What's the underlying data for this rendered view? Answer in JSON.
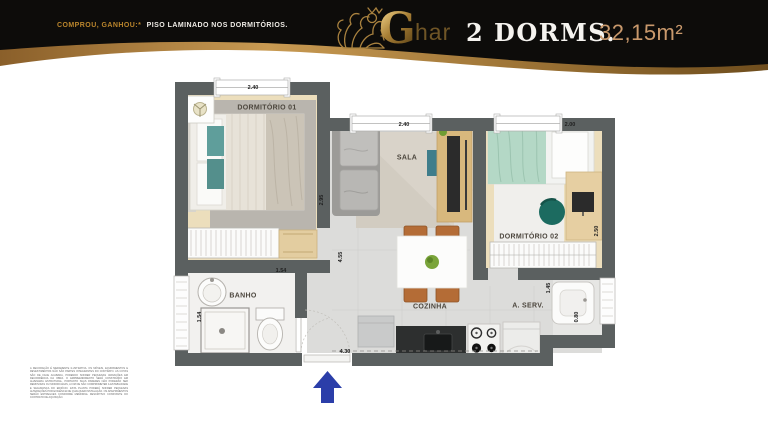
{
  "header": {
    "promo": {
      "highlight": "COMPROU, GANHOU:*",
      "rest": "PISO LAMINADO NOS DORMITÓRIOS."
    },
    "brand": {
      "g": "G",
      "har": "har",
      "lion_icon": "lion-logo-icon"
    },
    "dorms_label": "2 DORMS.",
    "area_label": "32,15m²",
    "colors": {
      "banner_black": "#0d0c0a",
      "gold": "#b9852c",
      "tan": "#c9996c"
    }
  },
  "floorplan": {
    "labels": {
      "dorm01": "DORMITÓRIO 01",
      "sala": "SALA",
      "dorm02": "DORMITÓRIO 02",
      "banho": "BANHO",
      "cozinha": "COZINHA",
      "aserv": "A. SERV."
    },
    "dims": {
      "dorm01_width": "2.40",
      "sala_width": "2.40",
      "dorm02_width": "2.00",
      "dorm01_depth": "2.95",
      "dorm02_depth": "2.50",
      "banho_width": "1.54",
      "banho_depth": "1.54",
      "living_depth": "4.55",
      "aserv_depth": "1.45",
      "aserv_width": "0.80",
      "entry_width": "4.30"
    },
    "wall_color": "#5b6060",
    "entry_arrow_color": "#2b3ea9"
  },
  "footer": {
    "disclaimer": "A DECORAÇÃO É MERAMENTE ILUSTRATIVA. OS MÓVEIS, EQUIPAMENTOS E REVESTIMENTOS NÃO SÃO PARTES INTEGRANTES DO CONTRATO. AS COTAS SÃO DE FACE ACABADA, PODENDO SOFRER PEQUENAS VARIAÇÕES EM DECORRÊNCIA DA OBRA. O EMPREENDIMENTO SERÁ CONSTRUÍDO EM ALVENARIA ESTRUTURAL, PORTANTO SUAS PAREDES NÃO PODERÃO SER REMOVIDAS OU MODIFICADAS, A FIM DE NÃO COMPROMETER A ESTABILIDADE E SEGURANÇA DO EDIFÍCIO. ESTA PLANTA PODERÁ SOFRER PEQUENAS ALTERAÇÕES POR EXIGÊNCIA DE QUALQUER INSTALAÇÃO. OS APARTAMENTOS SERÃO ENTREGUES CONFORME MEMORIAL DESCRITIVO CONSTANTE DO CONTRATO DE AQUISIÇÃO."
  }
}
